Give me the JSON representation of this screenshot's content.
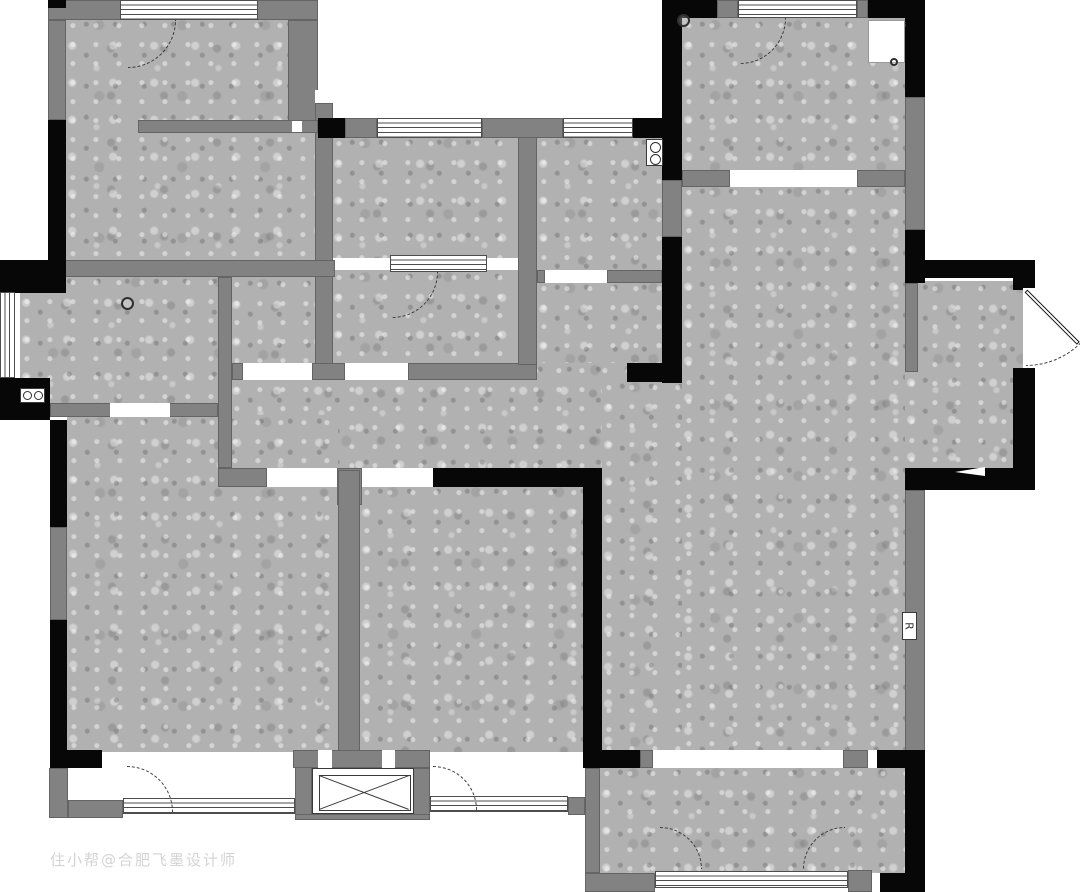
{
  "meta": {
    "canvas": {
      "width": 1080,
      "height": 892
    }
  },
  "palette": {
    "wall_black": "#070707",
    "wall_gray": "#828282",
    "floor_gray": "#b1b1b1",
    "line": "#3a3a3a",
    "background": "#ffffff"
  },
  "watermark": {
    "text": "住小帮@合肥飞墨设计师"
  },
  "plan": {
    "floors": [
      [
        "bedroom-top-left",
        66,
        18,
        252,
        244
      ],
      [
        "kitchen",
        20,
        275,
        198,
        130
      ],
      [
        "pantry-nook",
        230,
        277,
        85,
        193
      ],
      [
        "closet-room",
        332,
        136,
        186,
        122
      ],
      [
        "bath-room-a",
        332,
        270,
        186,
        97
      ],
      [
        "laundry",
        537,
        136,
        125,
        136
      ],
      [
        "bathroom",
        537,
        281,
        125,
        99
      ],
      [
        "corridor",
        230,
        363,
        452,
        107
      ],
      [
        "living-hall",
        682,
        185,
        223,
        565
      ],
      [
        "hall-extension",
        602,
        380,
        80,
        370
      ],
      [
        "entry",
        905,
        281,
        118,
        189
      ],
      [
        "bedroom-bottom-left",
        67,
        415,
        271,
        337
      ],
      [
        "bedroom-middle",
        360,
        485,
        223,
        267
      ],
      [
        "room-bottom-right",
        600,
        766,
        305,
        109
      ],
      [
        "bedroom-top-right",
        682,
        18,
        223,
        152
      ]
    ],
    "gray_walls": [
      [
        48,
        0,
        270,
        20
      ],
      [
        48,
        20,
        18,
        100
      ],
      [
        288,
        20,
        30,
        113
      ],
      [
        315,
        103,
        18,
        262
      ],
      [
        138,
        120,
        180,
        13
      ],
      [
        20,
        260,
        315,
        17
      ],
      [
        218,
        277,
        14,
        191
      ],
      [
        50,
        403,
        168,
        14
      ],
      [
        218,
        468,
        49,
        19
      ],
      [
        337,
        468,
        25,
        37
      ],
      [
        338,
        470,
        22,
        298
      ],
      [
        408,
        363,
        129,
        17
      ],
      [
        232,
        363,
        11,
        17
      ],
      [
        312,
        363,
        33,
        17
      ],
      [
        518,
        118,
        19,
        247
      ],
      [
        345,
        118,
        32,
        20
      ],
      [
        482,
        118,
        81,
        20
      ],
      [
        537,
        270,
        8,
        13
      ],
      [
        607,
        270,
        55,
        13
      ],
      [
        682,
        170,
        48,
        17
      ],
      [
        857,
        170,
        48,
        17
      ],
      [
        717,
        0,
        21,
        18
      ],
      [
        857,
        0,
        11,
        18
      ],
      [
        905,
        97,
        20,
        133
      ],
      [
        905,
        283,
        13,
        89
      ],
      [
        905,
        490,
        20,
        262
      ],
      [
        640,
        750,
        13,
        18
      ],
      [
        843,
        750,
        25,
        18
      ],
      [
        585,
        768,
        15,
        105
      ],
      [
        585,
        873,
        70,
        19
      ],
      [
        848,
        870,
        24,
        22
      ],
      [
        50,
        527,
        17,
        93
      ],
      [
        49,
        768,
        19,
        50
      ],
      [
        68,
        800,
        55,
        18
      ],
      [
        295,
        750,
        17,
        68
      ],
      [
        293,
        750,
        137,
        18
      ],
      [
        568,
        797,
        17,
        18
      ],
      [
        413,
        768,
        17,
        50
      ],
      [
        295,
        814,
        135,
        6
      ]
    ],
    "black_walls": [
      [
        48,
        120,
        18,
        142
      ],
      [
        0,
        260,
        66,
        33
      ],
      [
        0,
        378,
        50,
        42
      ],
      [
        50,
        420,
        17,
        107
      ],
      [
        50,
        620,
        17,
        130
      ],
      [
        50,
        750,
        52,
        18
      ],
      [
        318,
        118,
        27,
        20
      ],
      [
        633,
        118,
        40,
        20
      ],
      [
        662,
        0,
        20,
        383
      ],
      [
        627,
        363,
        55,
        19
      ],
      [
        433,
        468,
        169,
        19
      ],
      [
        583,
        487,
        19,
        281
      ],
      [
        585,
        750,
        55,
        18
      ],
      [
        877,
        750,
        48,
        18
      ],
      [
        905,
        750,
        20,
        140
      ],
      [
        880,
        873,
        45,
        19
      ],
      [
        662,
        0,
        55,
        18
      ],
      [
        868,
        0,
        57,
        18
      ],
      [
        905,
        18,
        20,
        79
      ],
      [
        905,
        230,
        20,
        53
      ],
      [
        925,
        260,
        110,
        18
      ],
      [
        1013,
        260,
        22,
        30
      ],
      [
        1013,
        368,
        22,
        122
      ],
      [
        905,
        468,
        130,
        22
      ],
      [
        48,
        0,
        18,
        8
      ]
    ],
    "gray_overlays": [
      [
        662,
        180,
        20,
        57
      ]
    ],
    "windows_h": [
      [
        120,
        0,
        138,
        20
      ],
      [
        377,
        118,
        105,
        20
      ],
      [
        563,
        118,
        70,
        20
      ],
      [
        738,
        0,
        119,
        18
      ],
      [
        390,
        255,
        97,
        17
      ],
      [
        123,
        798,
        172,
        16
      ],
      [
        430,
        796,
        138,
        16
      ],
      [
        655,
        871,
        193,
        17
      ]
    ],
    "windows_v": [
      [
        0,
        292,
        15,
        86
      ]
    ],
    "slots": [
      [
        292,
        121,
        10,
        11
      ],
      [
        315,
        90,
        18,
        13
      ],
      [
        868,
        750,
        9,
        18
      ],
      [
        872,
        873,
        8,
        17
      ],
      [
        318,
        750,
        14,
        18
      ],
      [
        382,
        750,
        13,
        18
      ],
      [
        1023,
        288,
        12,
        80
      ],
      [
        110,
        403,
        60,
        14
      ],
      [
        730,
        170,
        127,
        17
      ],
      [
        545,
        270,
        62,
        13
      ],
      [
        267,
        468,
        70,
        19
      ],
      [
        362,
        468,
        71,
        19
      ],
      [
        653,
        750,
        190,
        18
      ],
      [
        243,
        363,
        69,
        17
      ],
      [
        345,
        363,
        63,
        17
      ]
    ],
    "doors": [
      [
        128,
        20,
        48,
        "tl"
      ],
      [
        392,
        272,
        46,
        "tl"
      ],
      [
        740,
        18,
        46,
        "tl"
      ],
      [
        868,
        22,
        38,
        "tl"
      ],
      [
        1026,
        288,
        78,
        "tl"
      ],
      [
        127,
        812,
        46,
        "bl"
      ],
      [
        433,
        810,
        44,
        "bl"
      ],
      [
        660,
        869,
        42,
        "bl"
      ],
      [
        845,
        869,
        42,
        "br"
      ]
    ],
    "leafs": [
      {
        "x": 1026,
        "y": 289,
        "len": 74,
        "deg": 45
      }
    ],
    "symbols": [
      {
        "type": "closet",
        "x": 868,
        "y": 20,
        "w": 37,
        "h": 43
      },
      {
        "type": "circle",
        "x": 121,
        "y": 297,
        "d": 13
      },
      {
        "type": "circle",
        "x": 677,
        "y": 14,
        "d": 13
      },
      {
        "type": "circle",
        "x": 890,
        "y": 58,
        "d": 8
      },
      {
        "type": "stove",
        "x": 20,
        "y": 388,
        "w": 25,
        "h": 15
      },
      {
        "type": "washer",
        "x": 646,
        "y": 139,
        "w": 17,
        "h": 27
      },
      {
        "type": "shaft",
        "x": 312,
        "y": 768,
        "w": 102,
        "h": 46
      },
      {
        "type": "label",
        "x": 902,
        "y": 612,
        "w": 15,
        "h": 28,
        "text": "R"
      },
      {
        "type": "wedge",
        "x": 955,
        "y": 467,
        "w": 30,
        "h": 9
      }
    ]
  }
}
